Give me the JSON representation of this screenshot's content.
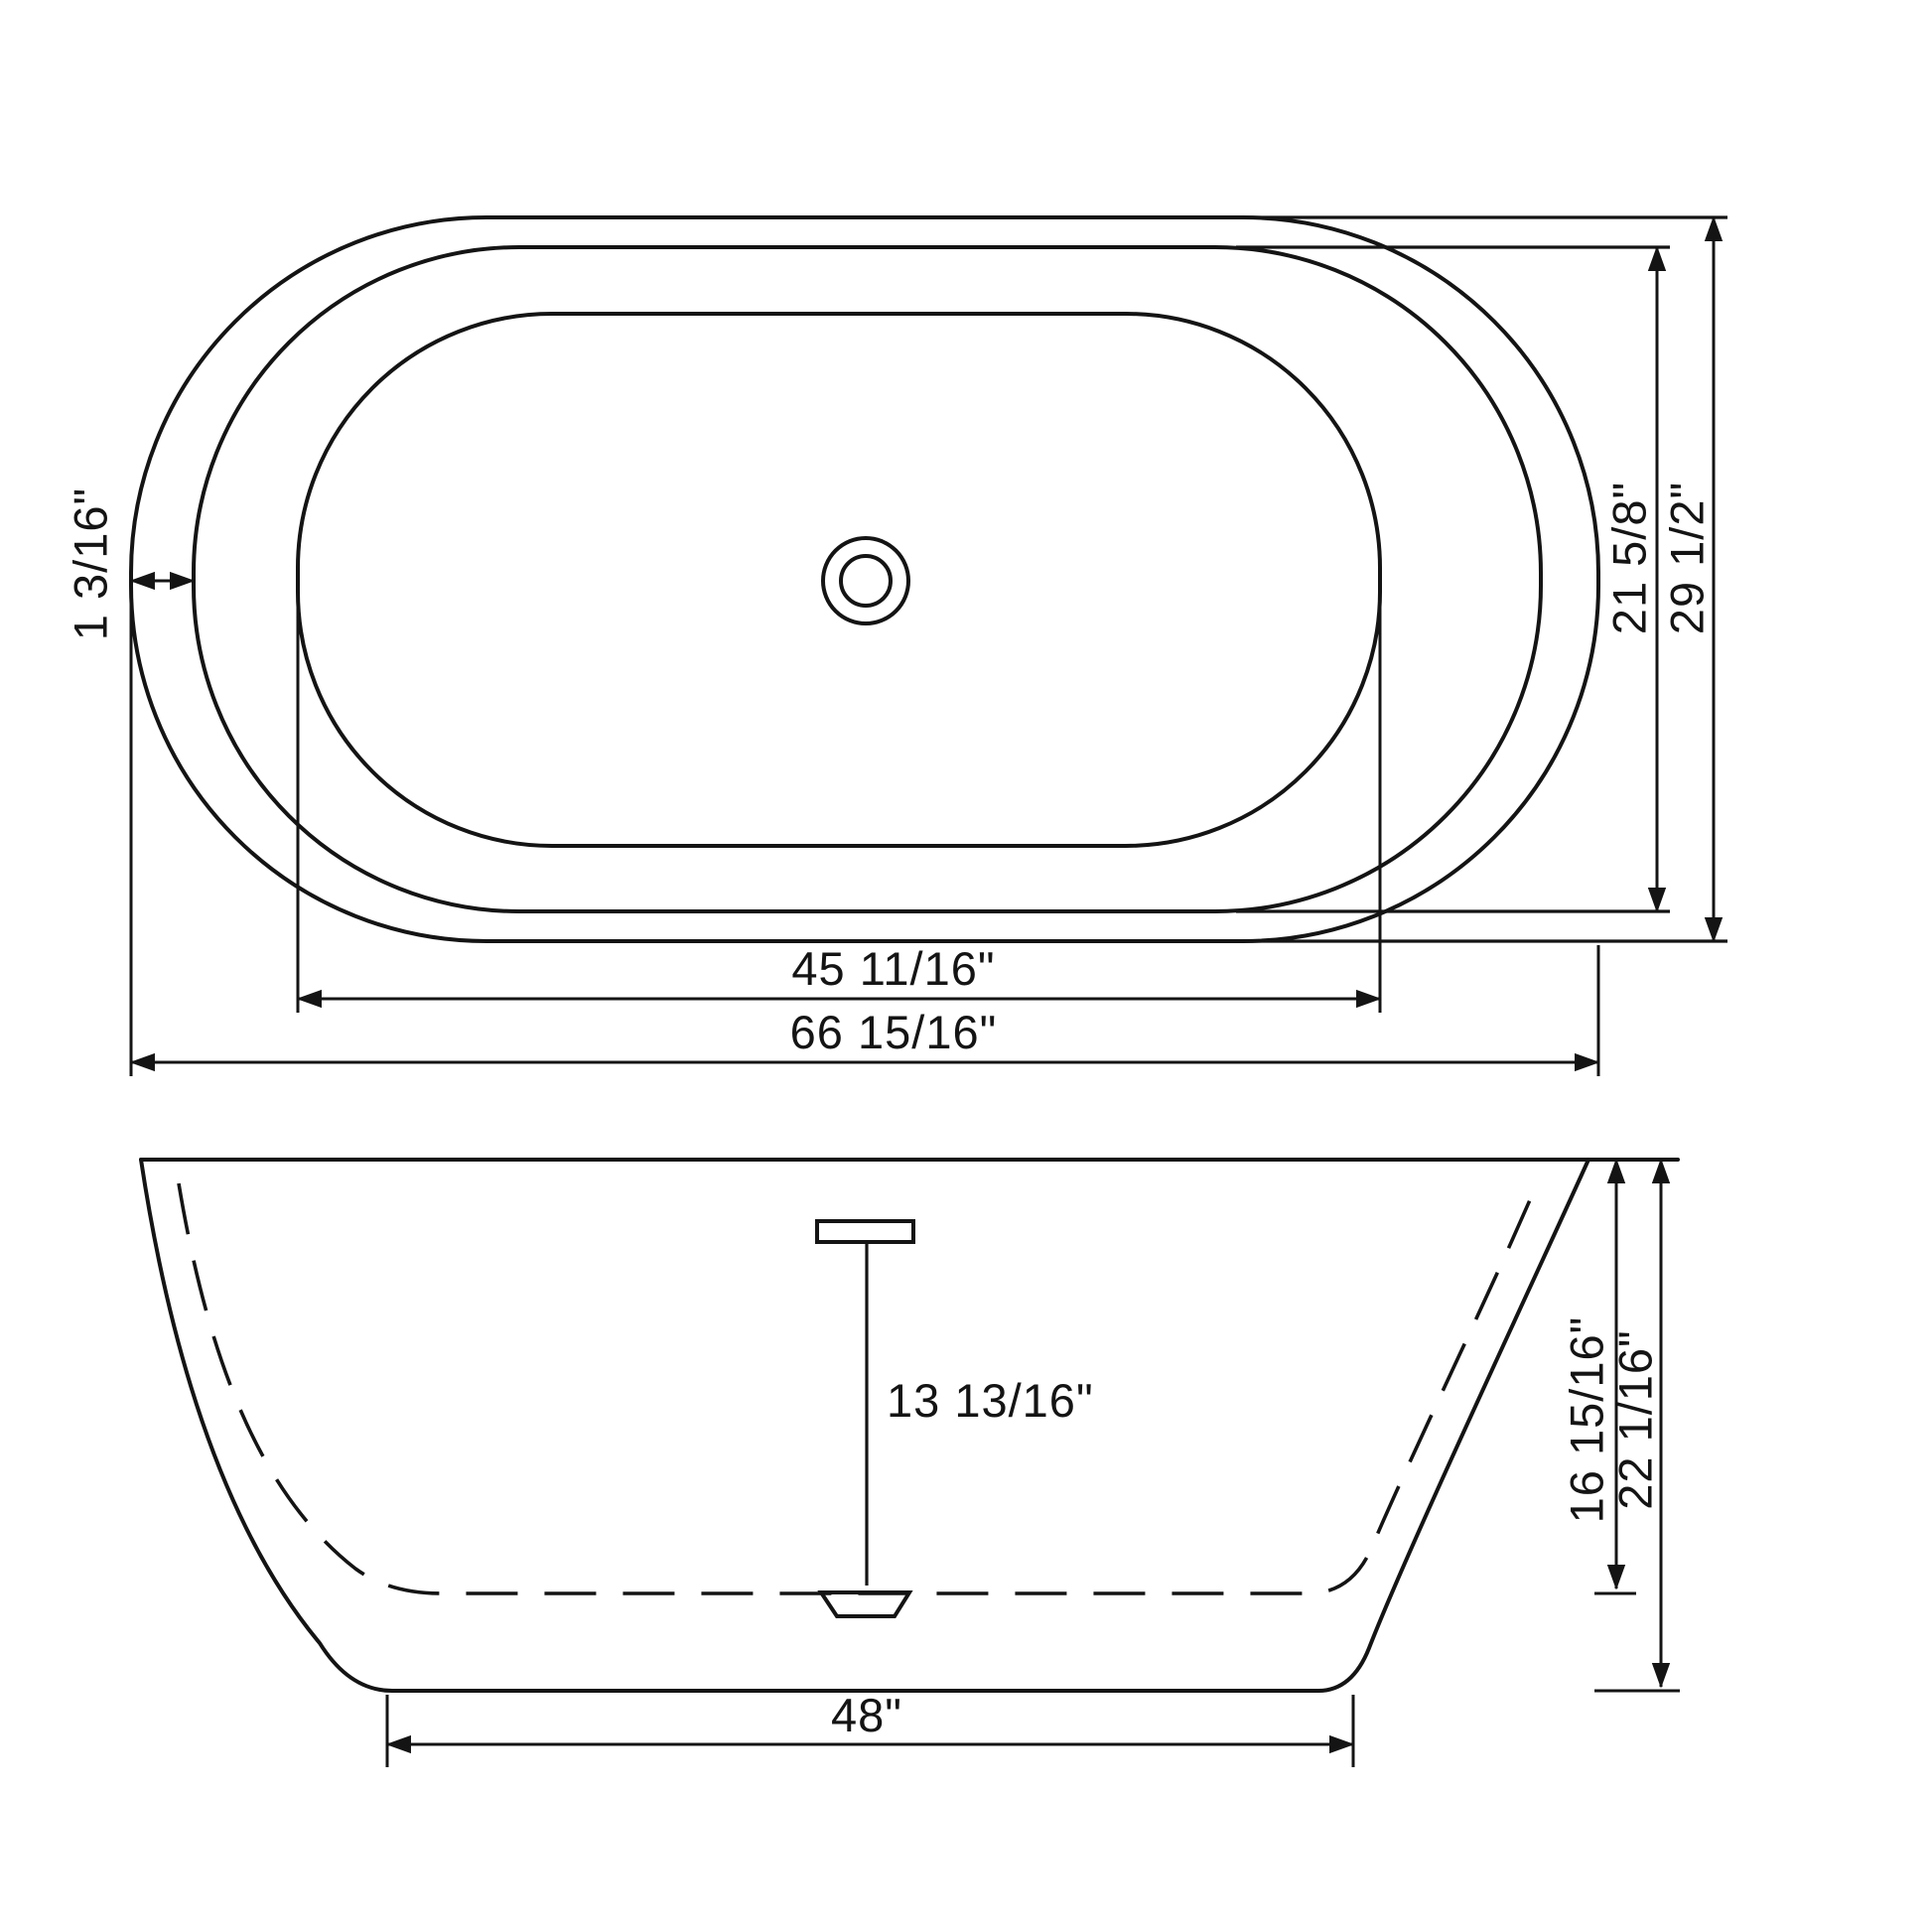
{
  "drawing": {
    "description": "Oval freestanding bathtub technical dimension drawing, top view and front view",
    "line_color": "#141414",
    "background_color": "#ffffff",
    "top_view": {
      "name": "top-view",
      "features": [
        "outer-rim-oval",
        "inner-rim-oval",
        "basin-oval",
        "drain-circles"
      ],
      "labels": {
        "rim_width": "1 3/16\"",
        "basin_length": "45 11/16\"",
        "overall_length": "66 15/16\"",
        "inner_width": "21 5/8\"",
        "overall_width": "29 1/2\""
      }
    },
    "front_view": {
      "name": "front-view",
      "features": [
        "rim-line",
        "outer-shell",
        "inner-shell-dashed",
        "overflow-pipe",
        "drain-fitting"
      ],
      "labels": {
        "drain_depth": "13 13/16\"",
        "interior_depth": "16 15/16\"",
        "overall_height": "22 1/16\"",
        "base_length": "48\""
      }
    }
  }
}
